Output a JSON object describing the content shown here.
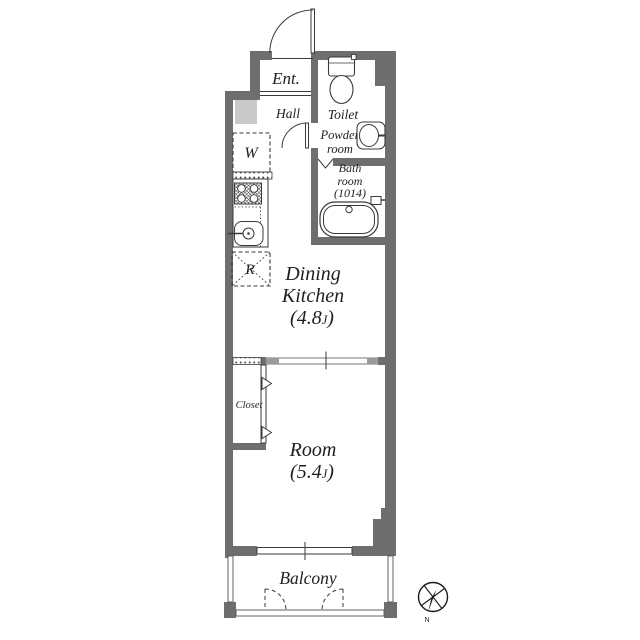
{
  "rooms": {
    "entrance": {
      "label": "Ent."
    },
    "hall": {
      "label": "Hall"
    },
    "toilet": {
      "label": "Toilet"
    },
    "powder_room": {
      "line1": "Powder",
      "line2": "room"
    },
    "bath_room": {
      "line1": "Bath",
      "line2": "room",
      "line3": "(1014)"
    },
    "dining_kitchen": {
      "line1": "Dining",
      "line2": "Kitchen",
      "size_open": "(4.8",
      "size_unit": "J",
      "size_close": ")"
    },
    "room": {
      "label": "Room",
      "size_open": "(5.4",
      "size_unit": "J",
      "size_close": ")"
    },
    "closet": {
      "label": "Closet"
    },
    "balcony": {
      "label": "Balcony"
    }
  },
  "fixtures": {
    "washing_machine": "W",
    "refrigerator": "R"
  },
  "compass": {
    "north_label": "N"
  },
  "colors": {
    "wall": "#6e6e6e",
    "line": "#3a3a3a",
    "shaft_fill": "#c9c9c9",
    "sliding_door_cap": "#9a9a9a",
    "text": "#1f1f1f",
    "background": "#ffffff"
  }
}
